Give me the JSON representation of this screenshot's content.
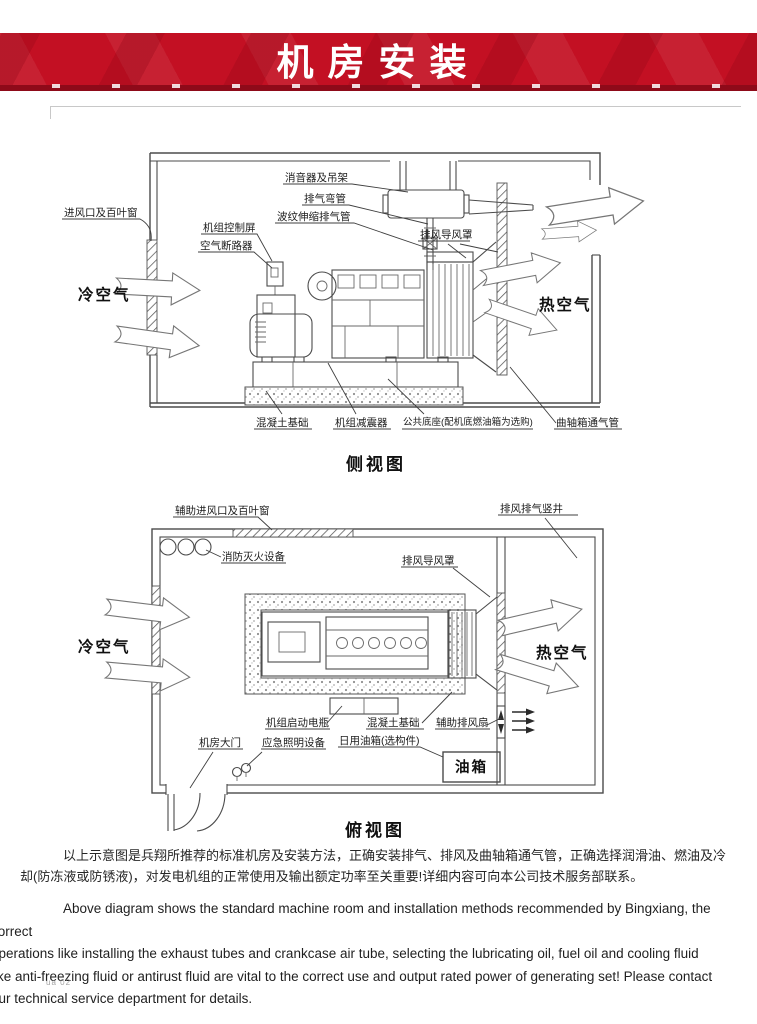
{
  "header": {
    "title": "机房安装",
    "banner_red": "#c31023",
    "banner_dark_red": "#8e0a19"
  },
  "side_view": {
    "caption": "侧视图",
    "labels": {
      "muffler": "消音器及吊架",
      "exhaust_elbow": "排气弯管",
      "bellows_pipe": "波纹伸缩排气管",
      "air_guide_hood": "排风导风罩",
      "control_panel": "机组控制屏",
      "air_breaker": "空气断路器",
      "air_inlet_louver": "进风口及百叶窗",
      "cold_air": "冷空气",
      "hot_air": "热空气",
      "concrete_base": "混凝土基础",
      "shock_absorber": "机组减震器",
      "common_base": "公共底座(配机底燃油箱为选购)",
      "crankcase_vent_pipe": "曲轴箱通气管"
    }
  },
  "top_view": {
    "caption": "俯视图",
    "labels": {
      "aux_inlet_louver": "辅助进风口及百叶窗",
      "exhaust_shaft": "排风排气竖井",
      "fire_equipment": "消防灭火设备",
      "air_guide_hood": "排风导风罩",
      "cold_air": "冷空气",
      "hot_air": "热空气",
      "start_battery": "机组启动电瓶",
      "concrete_base": "混凝土基础",
      "aux_exhaust_fan": "辅助排风扇",
      "room_door": "机房大门",
      "emergency_light": "应急照明设备",
      "daily_fuel_tank": "日用油箱(选构件)",
      "fuel_tank_box": "油箱"
    }
  },
  "notes": {
    "cn_lines": [
      "以上示意图是兵翔所推荐的标准机房及安装方法，正确安装排气、排风及曲轴箱通气管，正确选择润滑油、燃油及冷",
      "却(防冻液或防锈液)，对发电机组的正常使用及输出额定功率至关重要!详细内容可向本公司技术服务部联系。"
    ],
    "en_lines": [
      "Above diagram shows the standard machine room and installation methods recommended by Bingxiang, the correct",
      "operations like installing the exhaust tubes and crankcase air tube, selecting the lubricating oil, fuel oil and cooling fluid",
      "like anti-freezing fluid or antirust fluid are vital to the correct use and output rated power of generating set! Please contact",
      "our technical service department for details."
    ]
  },
  "footer_mark": "ua 02"
}
